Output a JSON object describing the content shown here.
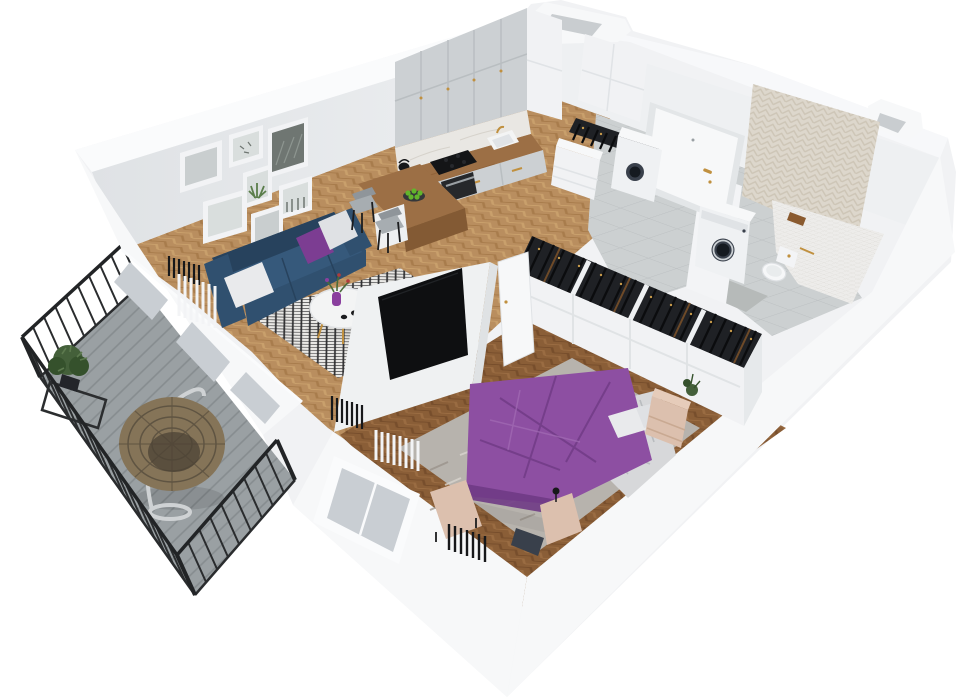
{
  "meta": {
    "title": "3D isometric floor plan render of a one-bedroom apartment with balcony",
    "width": 957,
    "height": 700
  },
  "scene": {
    "rooms": [
      {
        "name": "living-room",
        "objects": [
          "gallery-wall-7-frames",
          "blue-sofa",
          "white-pillows",
          "purple-pillow",
          "round-white-coffee-table",
          "purple-vase-with-flowers",
          "black-white-diamond-rug",
          "radiator",
          "vertical-blinds",
          "tv-partition-wall",
          "flat-tv"
        ]
      },
      {
        "name": "kitchen",
        "objects": [
          "gray-upper-cabinets",
          "marble-backsplash",
          "wood-countertop",
          "black-cooktop",
          "oven",
          "sink-with-brass-faucet",
          "black-kettle",
          "wood-bar-peninsula",
          "two-gray-bar-chairs",
          "plate-of-green-apples",
          "tall-white-cabinet"
        ]
      },
      {
        "name": "hallway",
        "objects": [
          "entrance-door-with-brass-handle",
          "tall-wardrobe",
          "shoe-rack",
          "dryer-unit",
          "gray-floor-tiles",
          "vent-shaft"
        ]
      },
      {
        "name": "bathroom",
        "objects": [
          "herringbone-accent-wall",
          "white-mosaic-tub",
          "washing-machine",
          "wall-hung-toilet",
          "brass-accessories",
          "gray-floor-tiles",
          "corner-vent-shaft"
        ]
      },
      {
        "name": "bedroom",
        "objects": [
          "double-bed-purple-duvet",
          "white-crumpled-blanket",
          "pillows",
          "open-top-wardrobes-with-hanging-clothes",
          "beige-nightstands",
          "beige-bench",
          "mottled-gray-rug",
          "radiators",
          "window",
          "vertical-blinds",
          "dark-herringbone-floor"
        ]
      },
      {
        "name": "balcony",
        "objects": [
          "black-metal-railing",
          "gray-plank-decking",
          "hanging-rattan-egg-chair",
          "potted-plant",
          "black-wire-side-table"
        ]
      }
    ]
  },
  "palette": {
    "background": "#ffffff",
    "silhouette": "#f1f2f4",
    "wallTop": "#fafbfc",
    "wallTopNE": "#f7f8fa",
    "wallInnerA": "#dfe2e5",
    "wallInnerB": "#eef0f2",
    "wallBand": "#f7f8f9",
    "wallCap": "#eef0f2",
    "wallEdge": "#e0e3e6",
    "holeGray": "#c9cdd0",
    "glass": "#c9ced3",
    "frameWhite": "#f2f3f5",
    "frameStroke": "#dcdfe2",
    "pictureGray": "#c9cecf",
    "pictureGrayLight": "#d9dedd",
    "pictureDark": "#6f7672",
    "pictureStroke": "#9aa39d",
    "plantArt": "#5a7d4a",
    "floorWood": "#b98e5f",
    "floorWoodDark": "#a87c4c",
    "floorWoodLight": "#c9a06c",
    "bedWoodBase": "#8a5e37",
    "bedWoodDark": "#774e2c",
    "bedWoodLight": "#9a6c42",
    "tileBase": "#ccd0d1",
    "tileLine": "#bcc0c2",
    "tileMat": "#b6bab9",
    "mosaicBase": "#edecea",
    "mosaicLine": "#dcdad5",
    "accentBase": "#ddd7cc",
    "accentLine": "#cdc5b6",
    "deckBase": "#9aa0a3",
    "deckLine": "#868c8f",
    "railing": "#2a2c2e",
    "railingDark": "#222426",
    "cabinetGray": "#ccd0d3",
    "cabinetLine": "#b9bec1",
    "marble": "#e9e7e3",
    "marbleVein": "#d6d2cb",
    "counterWood": "#9c6f45",
    "counterWoodDark": "#85582f",
    "barWoodSide": "#835a34",
    "applianceBlack": "#141517",
    "ovenDark": "#26282b",
    "steel": "#9aa0a4",
    "brass": "#c0903f",
    "sofaBlue": "#30506f",
    "sofaBlueDark": "#27425d",
    "sofaBlueLight": "#36597b",
    "pillowWhite": "#e9eaec",
    "pillowWhite2": "#dfe1e4",
    "pillowPurple": "#7c3d92",
    "rugBase": "#e9e8e5",
    "rugLine": "#2f2f31",
    "tableWhite": "#f3f4f4",
    "tableStroke": "#e2e4e6",
    "vasePurple": "#8a3f9e",
    "flowerGreen": "#4a6b3a",
    "flowerRed": "#b23b3b",
    "cupBlack": "#1b1c1e",
    "plateDark": "#35373a",
    "appleGreen": "#62b52b",
    "stoolGray": "#a7adb1",
    "stoolDark": "#8f959a",
    "legBlack": "#1c1d1f",
    "clothesBase": "#1f2125",
    "clothesStroke": "#0b0c0e",
    "clothesBrown": "#6e4a28",
    "hookGold": "#c79a4b",
    "wardrobeWhite": "#f1f2f4",
    "wardrobeLine": "#e0e3e5",
    "wardrobeEnd": "#e6e9eb",
    "duvetPurple": "#8d4fa2",
    "duvetPurpleDark": "#6f3a85",
    "duvetPurpleLight": "#a36cb5",
    "sheetGray": "#d7d8da",
    "sheetLine": "#b9bcbf",
    "beige": "#dcc0ae",
    "beigeLight": "#e6ccba",
    "beigeLine": "#c9a992",
    "rugBedroom": "#b7b3ad",
    "rugBedMottleDark": "#958f86",
    "rugBedMottleLight": "#d8d4ce",
    "washerWhite": "#eff1f3",
    "washerTop": "#f7f8f9",
    "washerDoor": "#39404b",
    "washerDoorInner": "#151a20",
    "washerRing": "#ccd1d5",
    "toiletWhite": "#f6f7f8",
    "toiletStroke": "#dde0e3",
    "toiletSeat": "#e9eced",
    "trayBrown": "#8a5a2f",
    "radiatorDark": "#17181a",
    "curtainWhite": "#f3f4f6",
    "chairRattan": "#857458",
    "chairRattanDark": "#5f5442",
    "chairInner": "#4c4336",
    "chairStand": "#cfd2d4",
    "plantGreen": "#44603a",
    "plantGreenDark": "#35512c",
    "plantGreenLight": "#5d7a4f",
    "potBlack": "#23252a",
    "tableFrameBlack": "#2b2d2f",
    "doorWhite": "#f7f8f9",
    "doorFrame": "#e3e6e8",
    "partitionWhite": "#eff1f2",
    "partitionEdge": "#dfe2e4",
    "tvBlack": "#0e0f11",
    "tvGlare": "#26282c",
    "shadow": "#000000"
  }
}
